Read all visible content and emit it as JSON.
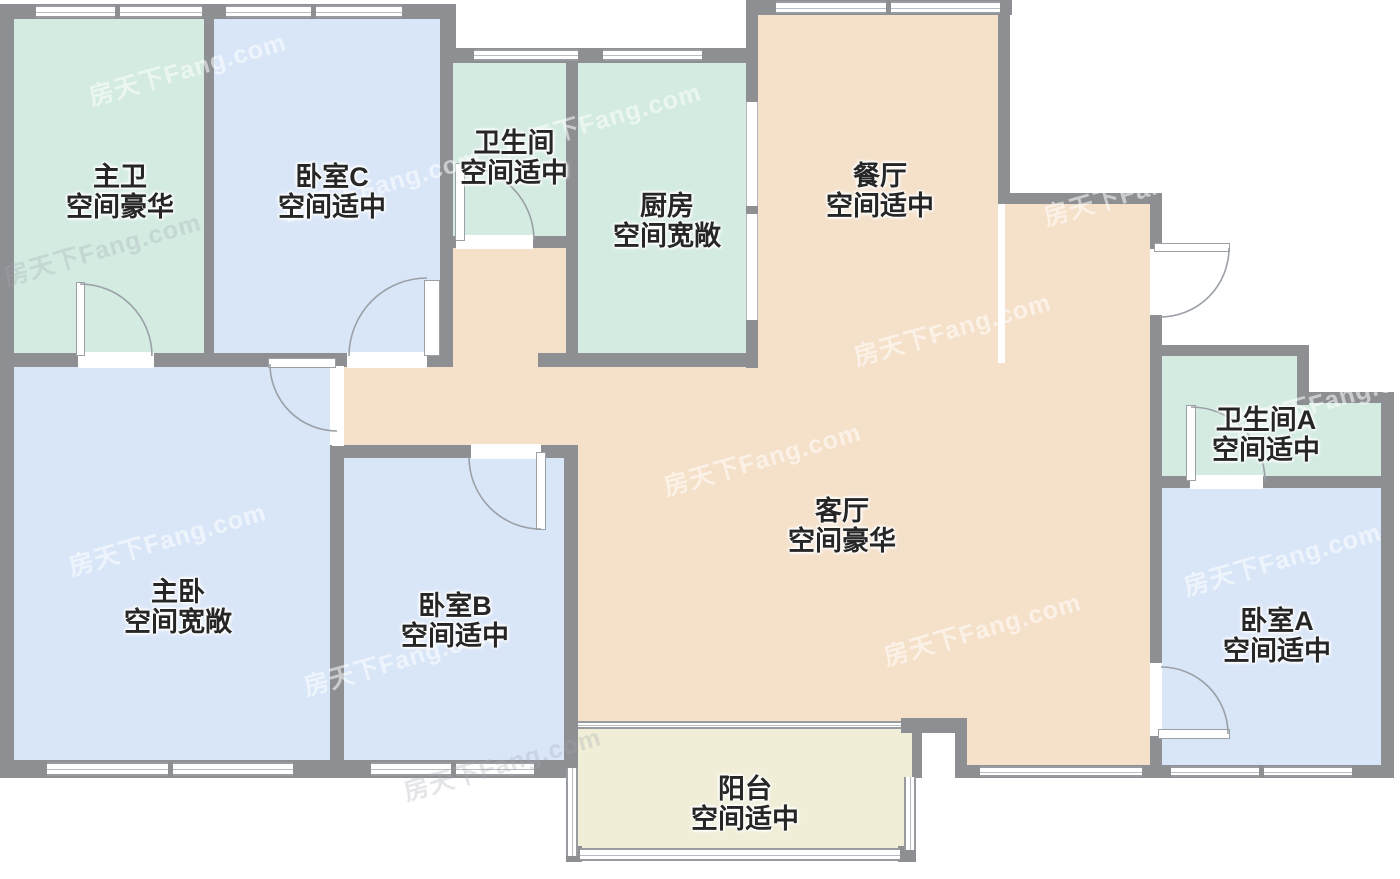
{
  "plan": {
    "title": "户型图",
    "watermark": "房天下Fang.com",
    "rooms": [
      {
        "id": "master-bath",
        "name": "主卫",
        "size": "空间豪华"
      },
      {
        "id": "bedroom-c",
        "name": "卧室C",
        "size": "空间适中"
      },
      {
        "id": "bathroom",
        "name": "卫生间",
        "size": "空间适中"
      },
      {
        "id": "kitchen",
        "name": "厨房",
        "size": "空间宽敞"
      },
      {
        "id": "dining-room",
        "name": "餐厅",
        "size": "空间适中"
      },
      {
        "id": "bathroom-a",
        "name": "卫生间A",
        "size": "空间适中"
      },
      {
        "id": "living-room",
        "name": "客厅",
        "size": "空间豪华"
      },
      {
        "id": "master-bedroom",
        "name": "主卧",
        "size": "空间宽敞"
      },
      {
        "id": "bedroom-b",
        "name": "卧室B",
        "size": "空间适中"
      },
      {
        "id": "bedroom-a",
        "name": "卧室A",
        "size": "空间适中"
      },
      {
        "id": "balcony",
        "name": "阳台",
        "size": "空间适中"
      }
    ],
    "colors": {
      "wall": "#8d8f92",
      "bedroom_fill": "#d9e6f8",
      "bath_kitchen_fill": "#d3ebe1",
      "living_fill": "#f5e0c9",
      "balcony_fill": "#f0eed6",
      "label_text": "#262626"
    }
  }
}
